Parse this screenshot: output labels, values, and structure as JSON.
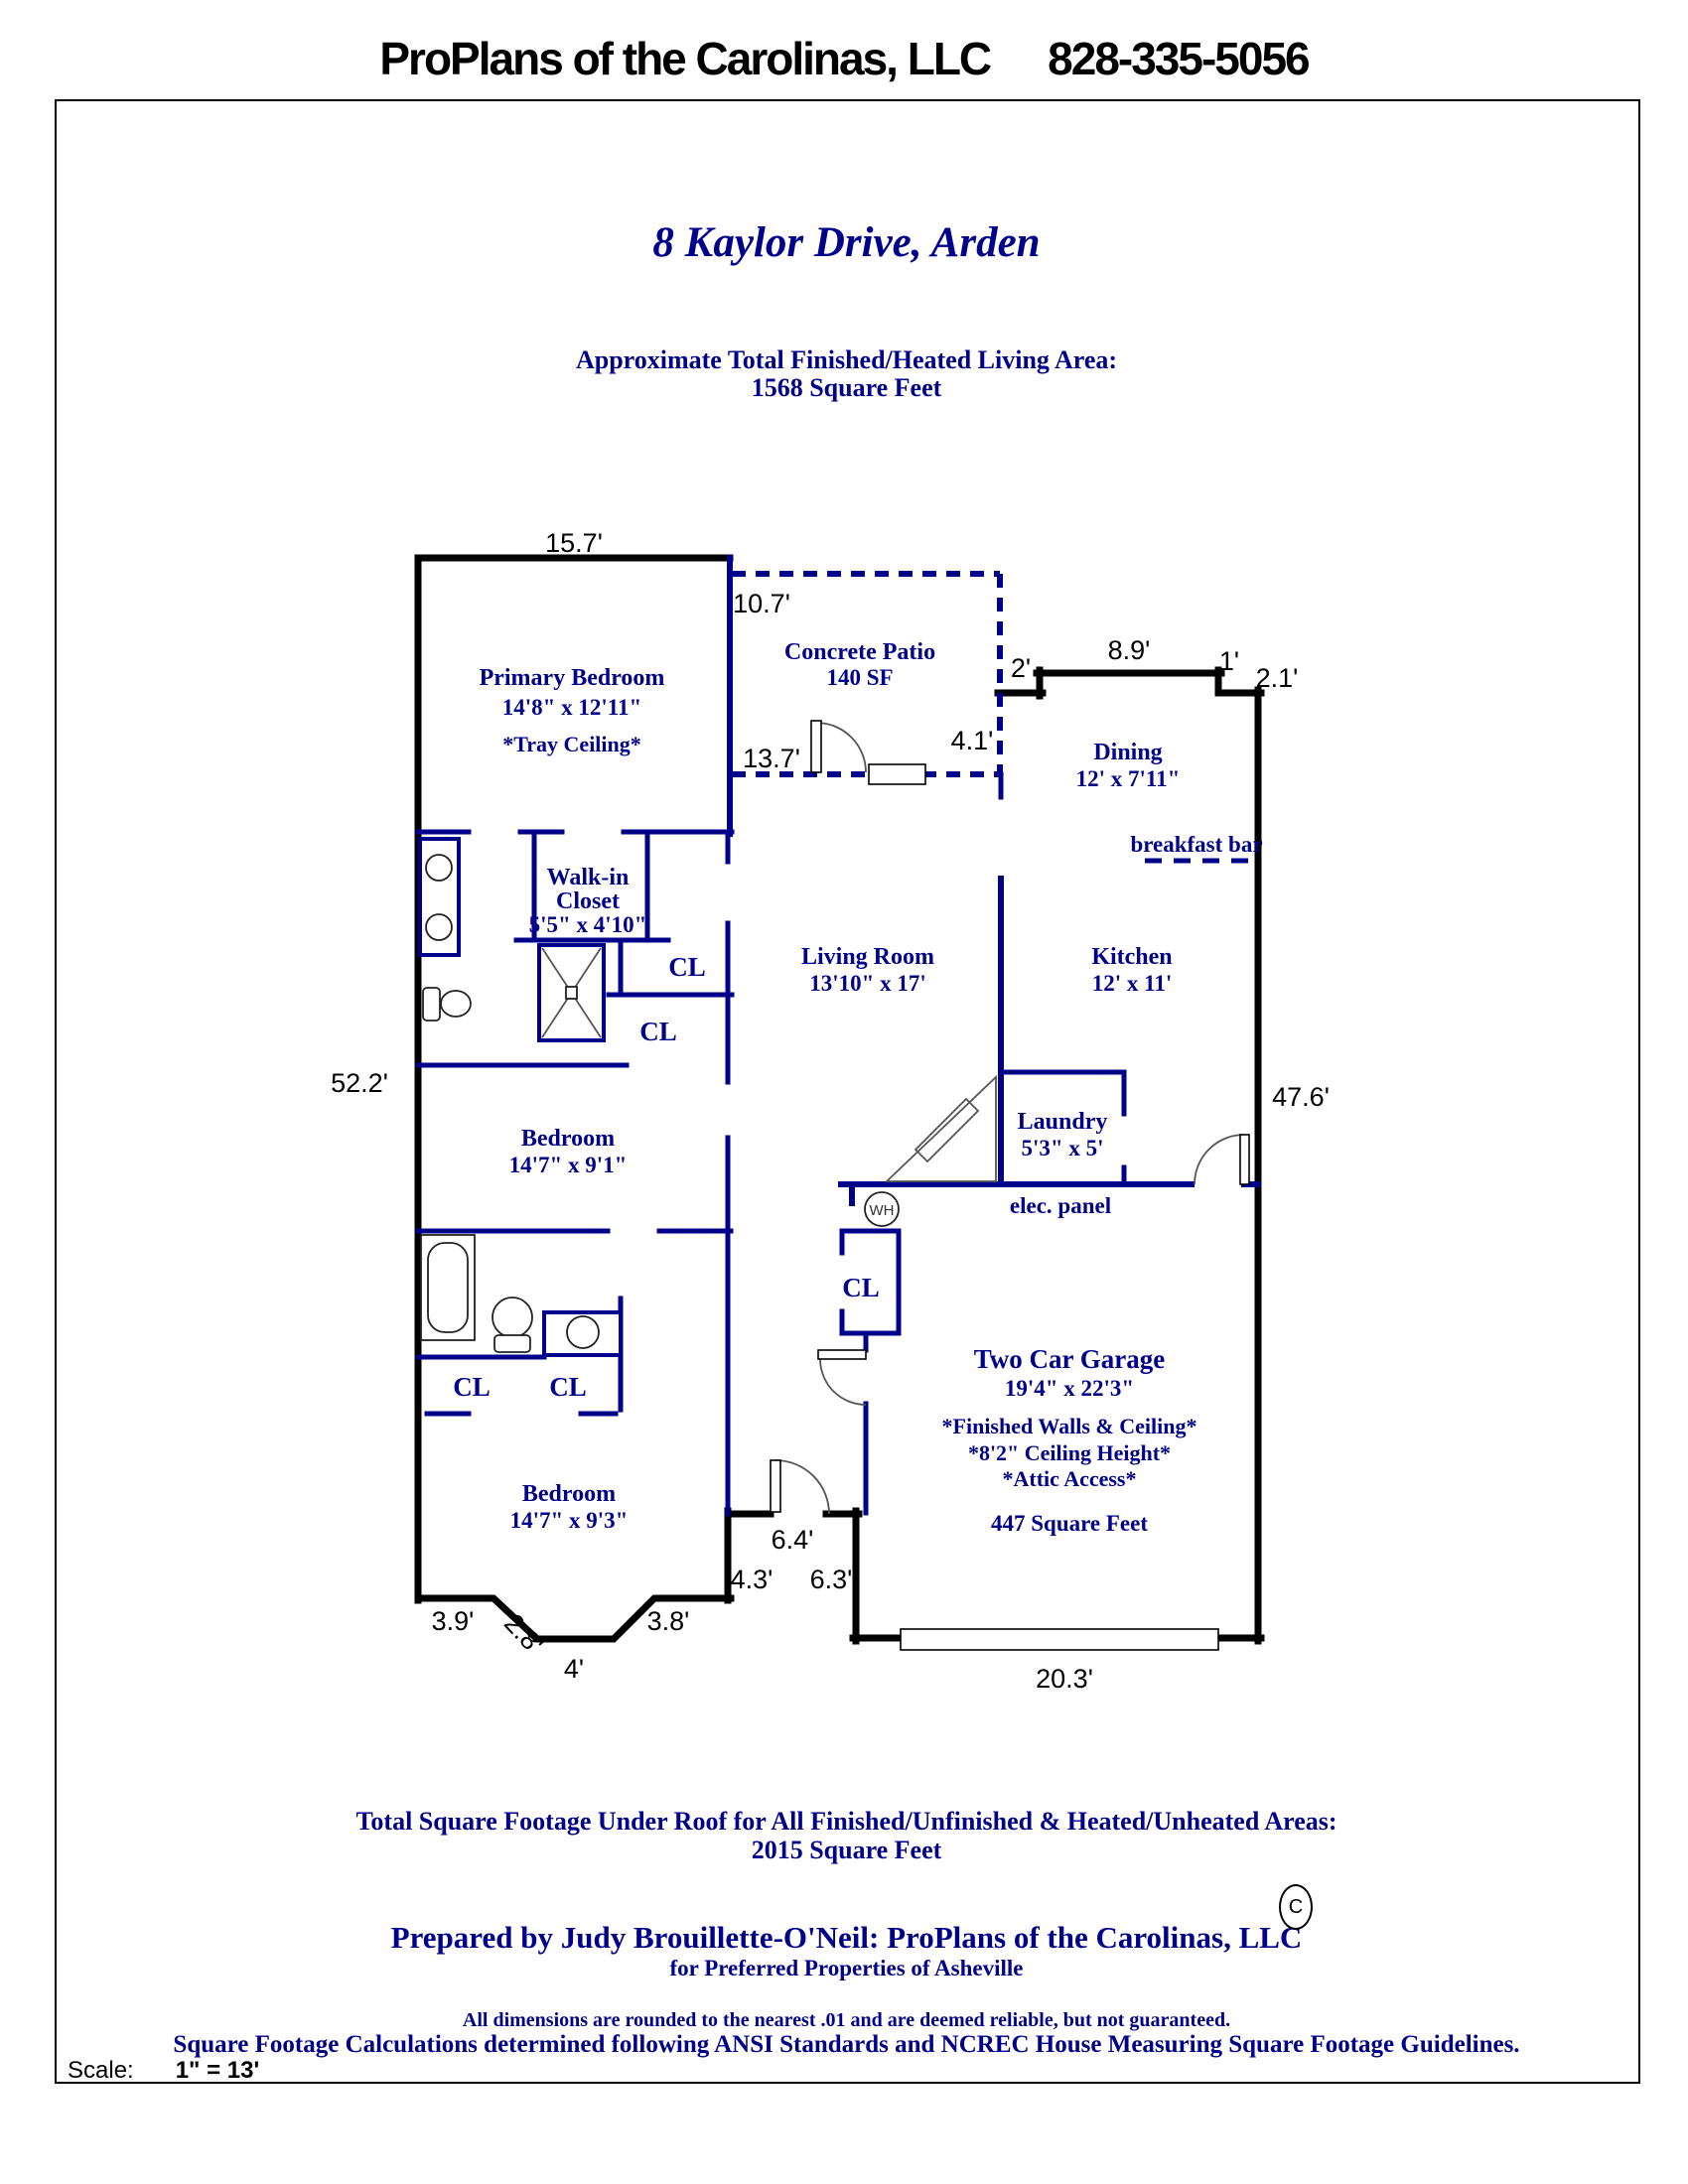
{
  "header": {
    "company": "ProPlans of the Carolinas, LLC",
    "phone": "828-335-5056"
  },
  "title": "8 Kaylor Drive, Arden",
  "living_area": {
    "line1": "Approximate Total Finished/Heated Living Area:",
    "line2": "1568 Square Feet"
  },
  "rooms": {
    "primary_bedroom": {
      "name": "Primary Bedroom",
      "dims": "14'8\" x 12'11\"",
      "note": "*Tray Ceiling*"
    },
    "patio": {
      "name": "Concrete Patio",
      "area": "140 SF"
    },
    "dining": {
      "name": "Dining",
      "dims": "12' x 7'11\""
    },
    "breakfast_bar": "breakfast bar",
    "walkin_closet": {
      "line1": "Walk-in",
      "line2": "Closet",
      "dims": "5'5\" x 4'10\""
    },
    "living_room": {
      "name": "Living Room",
      "dims": "13'10\" x 17'"
    },
    "kitchen": {
      "name": "Kitchen",
      "dims": "12' x 11'"
    },
    "laundry": {
      "name": "Laundry",
      "dims": "5'3\" x 5'"
    },
    "bedroom_mid": {
      "name": "Bedroom",
      "dims": "14'7\" x 9'1\""
    },
    "bedroom_front": {
      "name": "Bedroom",
      "dims": "14'7\" x 9'3\""
    },
    "garage": {
      "name": "Two Car Garage",
      "dims": "19'4\" x 22'3\"",
      "note1": "*Finished Walls & Ceiling*",
      "note2": "*8'2\" Ceiling Height*",
      "note3": "*Attic Access*",
      "area": "447 Square Feet"
    }
  },
  "labels": {
    "closet": "CL",
    "water_heater": "WH",
    "elec_panel": "elec. panel"
  },
  "dimensions": {
    "primary_top": "15.7'",
    "patio_top": "10.7'",
    "patio_bottom": "13.7'",
    "patio_right": "4.1'",
    "dining_step_left": "2'",
    "dining_top": "8.9'",
    "dining_step_right": "1'",
    "dining_right": "2.1'",
    "left_side": "52.2'",
    "right_side": "47.6'",
    "porch_top": "6.4'",
    "porch_left": "4.3'",
    "porch_right": "6.3'",
    "bay_left": "3.9'",
    "bay_angle": "2.8'",
    "bay_bottom": "4'",
    "bay_right": "3.8'",
    "garage_bottom": "20.3'"
  },
  "footer": {
    "total_line1": "Total Square Footage Under Roof for All Finished/Unfinished & Heated/Unheated Areas:",
    "total_line2": "2015 Square Feet",
    "prepared": "Prepared by Judy Brouillette-O'Neil: ProPlans of the Carolinas, LLC",
    "copyright": "C",
    "for_line": "for Preferred Properties of Asheville",
    "disclaimer1": "All dimensions are rounded to the nearest .01 and are deemed reliable, but not guaranteed.",
    "disclaimer2": "Square Footage Calculations determined following ANSI Standards and NCREC House Measuring Square Footage Guidelines.",
    "scale_label": "Scale:",
    "scale_value": "1\" = 13'"
  }
}
